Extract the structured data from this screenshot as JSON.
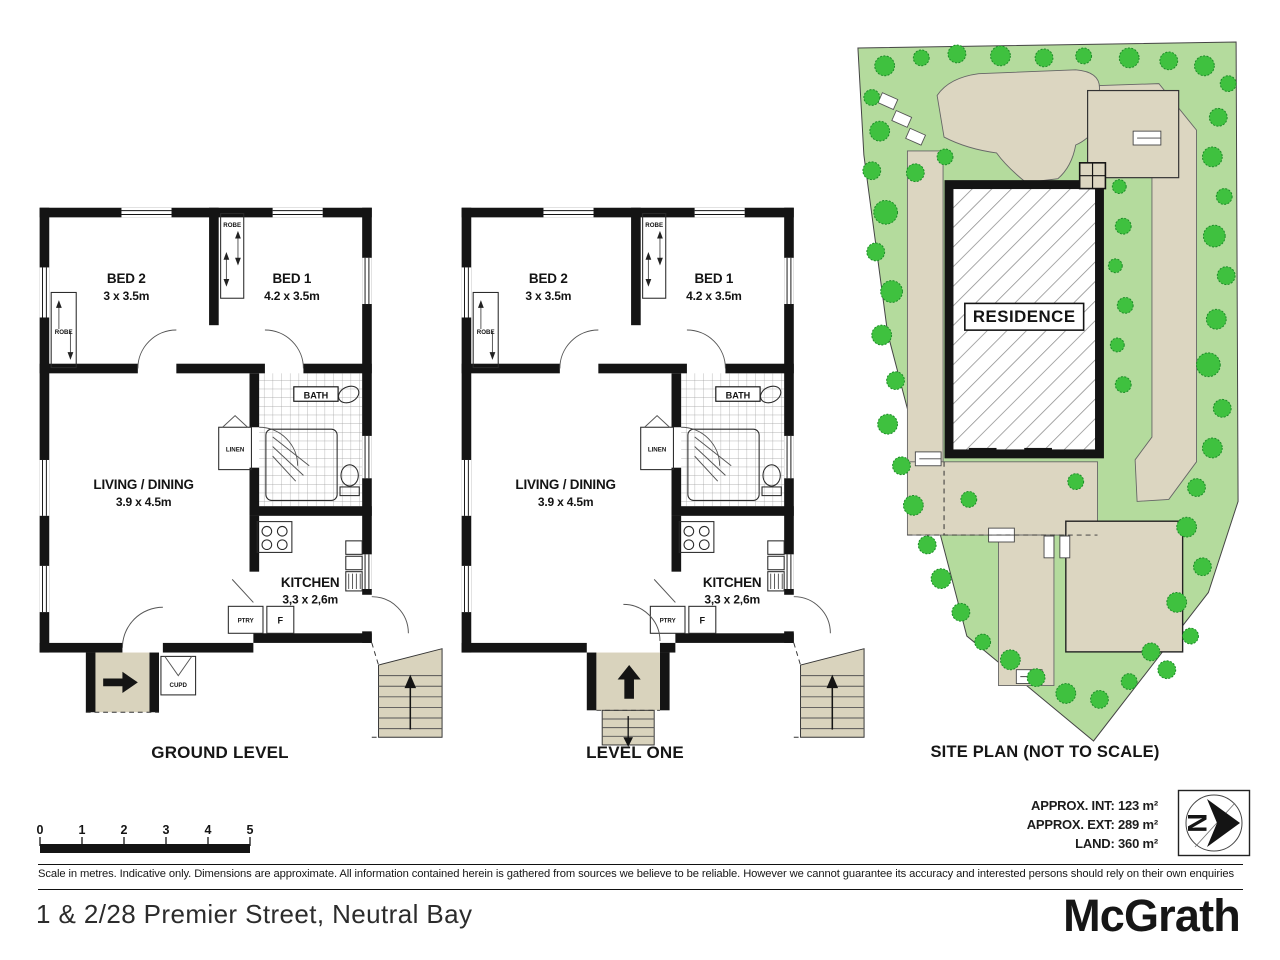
{
  "plans": [
    {
      "label": "GROUND LEVEL",
      "rooms": {
        "bed2": {
          "name": "BED 2",
          "dims": "3 x 3.5m"
        },
        "bed1": {
          "name": "BED 1",
          "dims": "4.2 x 3.5m"
        },
        "living": {
          "name": "LIVING / DINING",
          "dims": "3.9 x 4.5m"
        },
        "kitchen": {
          "name": "KITCHEN",
          "dims": "3,3 x 2,6m"
        }
      },
      "fx": {
        "bath": "BATH",
        "linen": "LINEN",
        "robeL": "ROBE",
        "robeM": "ROBE",
        "ptry": "PTRY",
        "fridge": "F",
        "cupd": "CUPD"
      }
    },
    {
      "label": "LEVEL ONE",
      "rooms": {
        "bed2": {
          "name": "BED 2",
          "dims": "3 x 3.5m"
        },
        "bed1": {
          "name": "BED 1",
          "dims": "4.2 x 3.5m"
        },
        "living": {
          "name": "LIVING / DINING",
          "dims": "3.9 x 4.5m"
        },
        "kitchen": {
          "name": "KITCHEN",
          "dims": "3,3 x 2,6m"
        }
      },
      "fx": {
        "bath": "BATH",
        "linen": "LINEN",
        "robeL": "ROBE",
        "robeM": "ROBE",
        "ptry": "PTRY",
        "fridge": "F"
      }
    }
  ],
  "site": {
    "title": "SITE PLAN (NOT TO SCALE)",
    "residence": "RESIDENCE"
  },
  "areas": {
    "int": "APPROX. INT: 123 m²",
    "ext": "APPROX. EXT: 289 m²",
    "land": "LAND: 360 m²"
  },
  "scale": {
    "ticks": [
      "0",
      "1",
      "2",
      "3",
      "4",
      "5"
    ]
  },
  "compass": {
    "letter": "N"
  },
  "footer": {
    "disclaimer": "Scale in metres. Indicative only. Dimensions are approximate. All information contained herein is gathered from sources we believe to be reliable. However we cannot guarantee its accuracy and interested persons should rely on their own enquiries",
    "address": "1 & 2/28 Premier Street, Neutral Bay",
    "brand": "McGrath"
  }
}
